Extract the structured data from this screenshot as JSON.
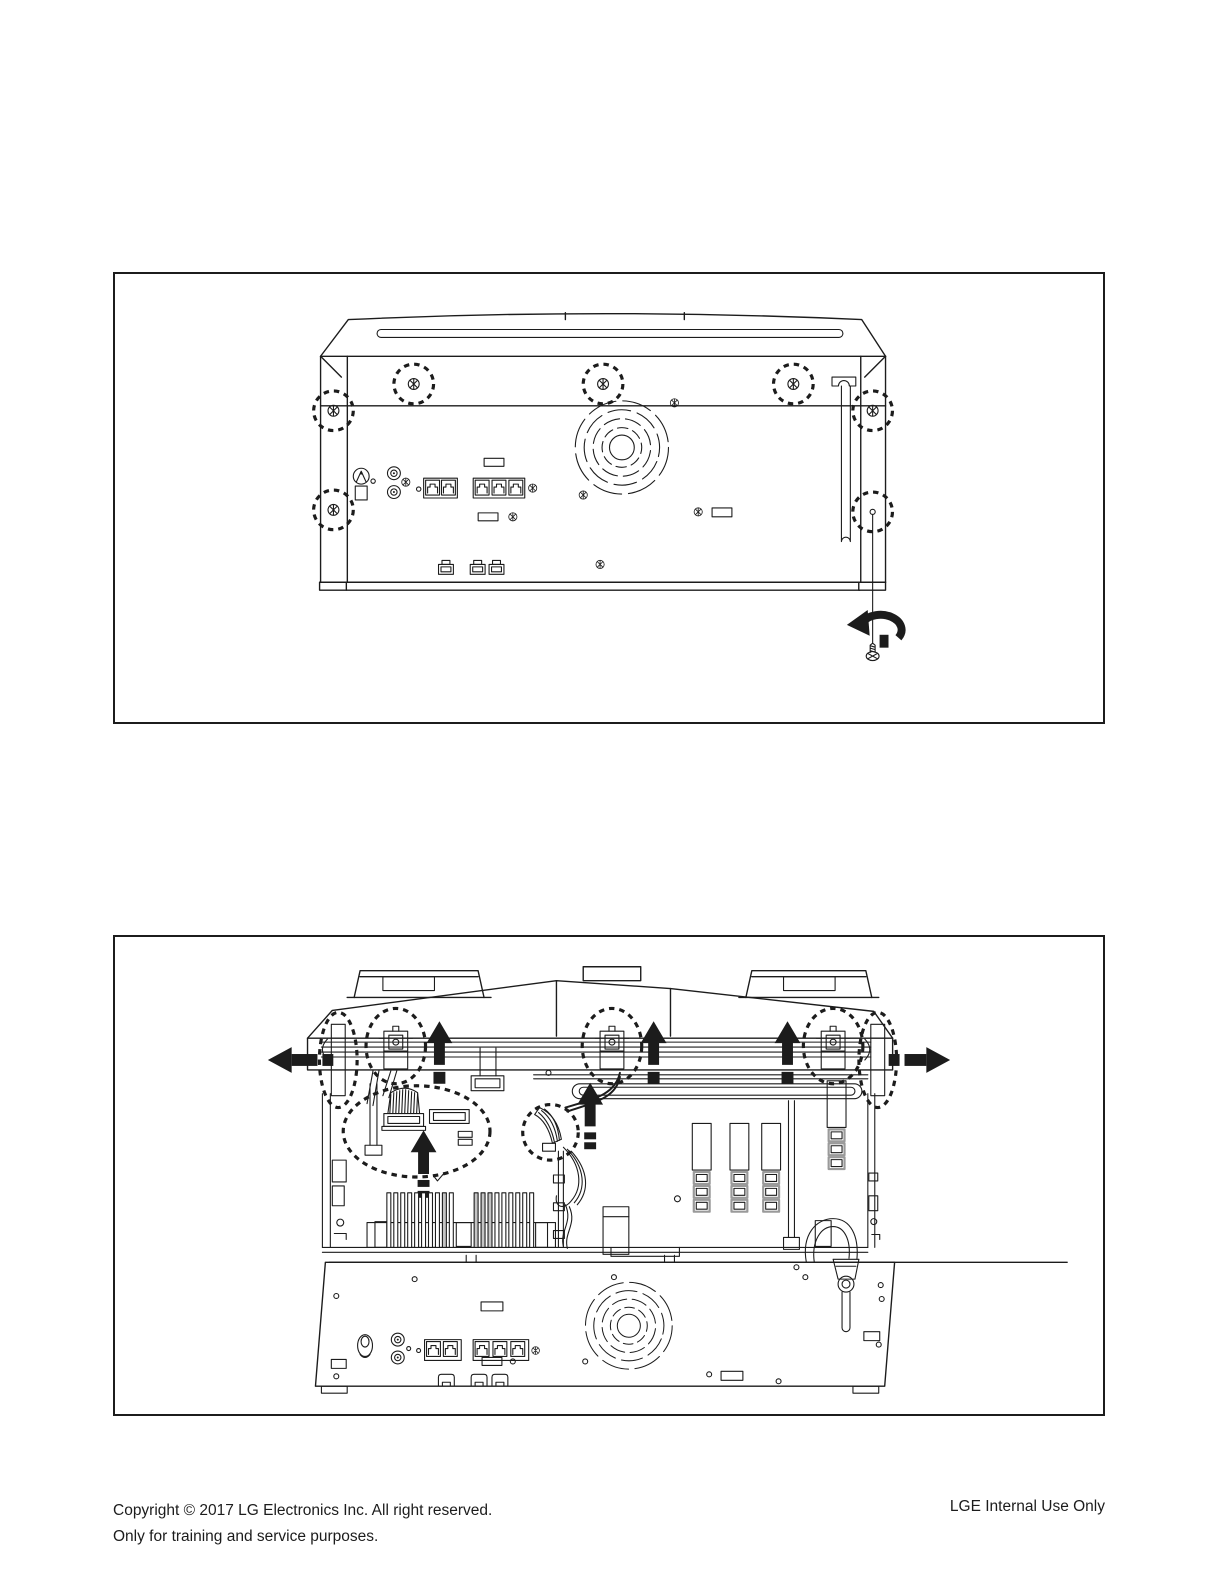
{
  "colors": {
    "ink": "#1c1c1c",
    "paper": "#ffffff"
  },
  "footer": {
    "left_line1": "Copyright © 2017 LG Electronics Inc. All right reserved.",
    "left_line2": "Only for training and service purposes.",
    "right": "LGE Internal Use Only"
  }
}
